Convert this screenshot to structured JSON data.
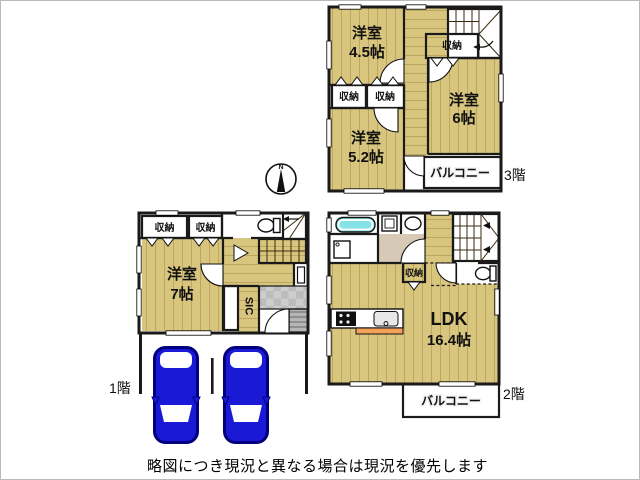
{
  "caption": "略図につき現況と異なる場合は現況を優先します",
  "compass": {
    "north": "N"
  },
  "floor3": {
    "label": "3階",
    "room45": {
      "name": "洋室",
      "size": "4.5帖"
    },
    "room52": {
      "name": "洋室",
      "size": "5.2帖"
    },
    "room6": {
      "name": "洋室",
      "size": "6帖"
    },
    "closets": [
      "収納",
      "収納",
      "収納"
    ],
    "balcony": "バルコニー"
  },
  "floor2": {
    "label": "2階",
    "ldk": {
      "name": "LDK",
      "size": "16.4帖"
    },
    "closet": "収納",
    "balcony": "バルコニー"
  },
  "floor1": {
    "label": "1階",
    "room7": {
      "name": "洋室",
      "size": "7帖"
    },
    "closets": [
      "収納",
      "収納"
    ],
    "sic": "SIC"
  },
  "colors": {
    "floor_wood": "#D9C67E",
    "closet_orange": "#F2A158",
    "balcony_gray": "#9E9E9E",
    "wall_black": "#1A1A1A",
    "bathtub_cyan": "#85E2E6",
    "car_blue": "#1A1AD6",
    "washroom_beige": "#D6C9B5"
  }
}
